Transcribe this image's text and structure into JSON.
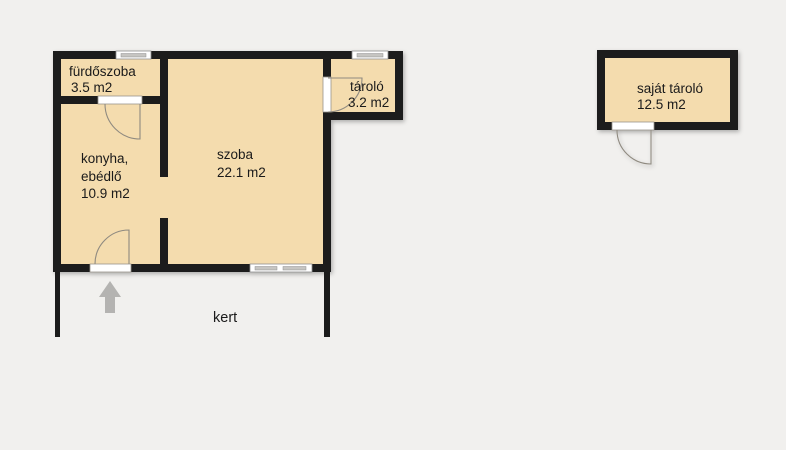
{
  "plan": {
    "rooms": {
      "bathroom": {
        "name": "fürdőszoba",
        "area": "3.5 m2"
      },
      "kitchen": {
        "name_line1": "konyha,",
        "name_line2": "ebédlő",
        "area": "10.9 m2"
      },
      "living_room": {
        "name": "szoba",
        "area": "22.1 m2"
      },
      "storage": {
        "name": "tároló",
        "area": "3.2 m2"
      },
      "own_storage": {
        "name": "saját tároló",
        "area": "12.5 m2"
      },
      "garden": {
        "name": "kert"
      }
    },
    "colors": {
      "background": "#f1f0ee",
      "room_fill": "#f4dcae",
      "wall": "#1b1b1b",
      "door_line": "#8f8a80",
      "window_pane": "#c6c5c2",
      "entrance_arrow": "#b4b3b1",
      "text": "#1a1a1a"
    }
  }
}
